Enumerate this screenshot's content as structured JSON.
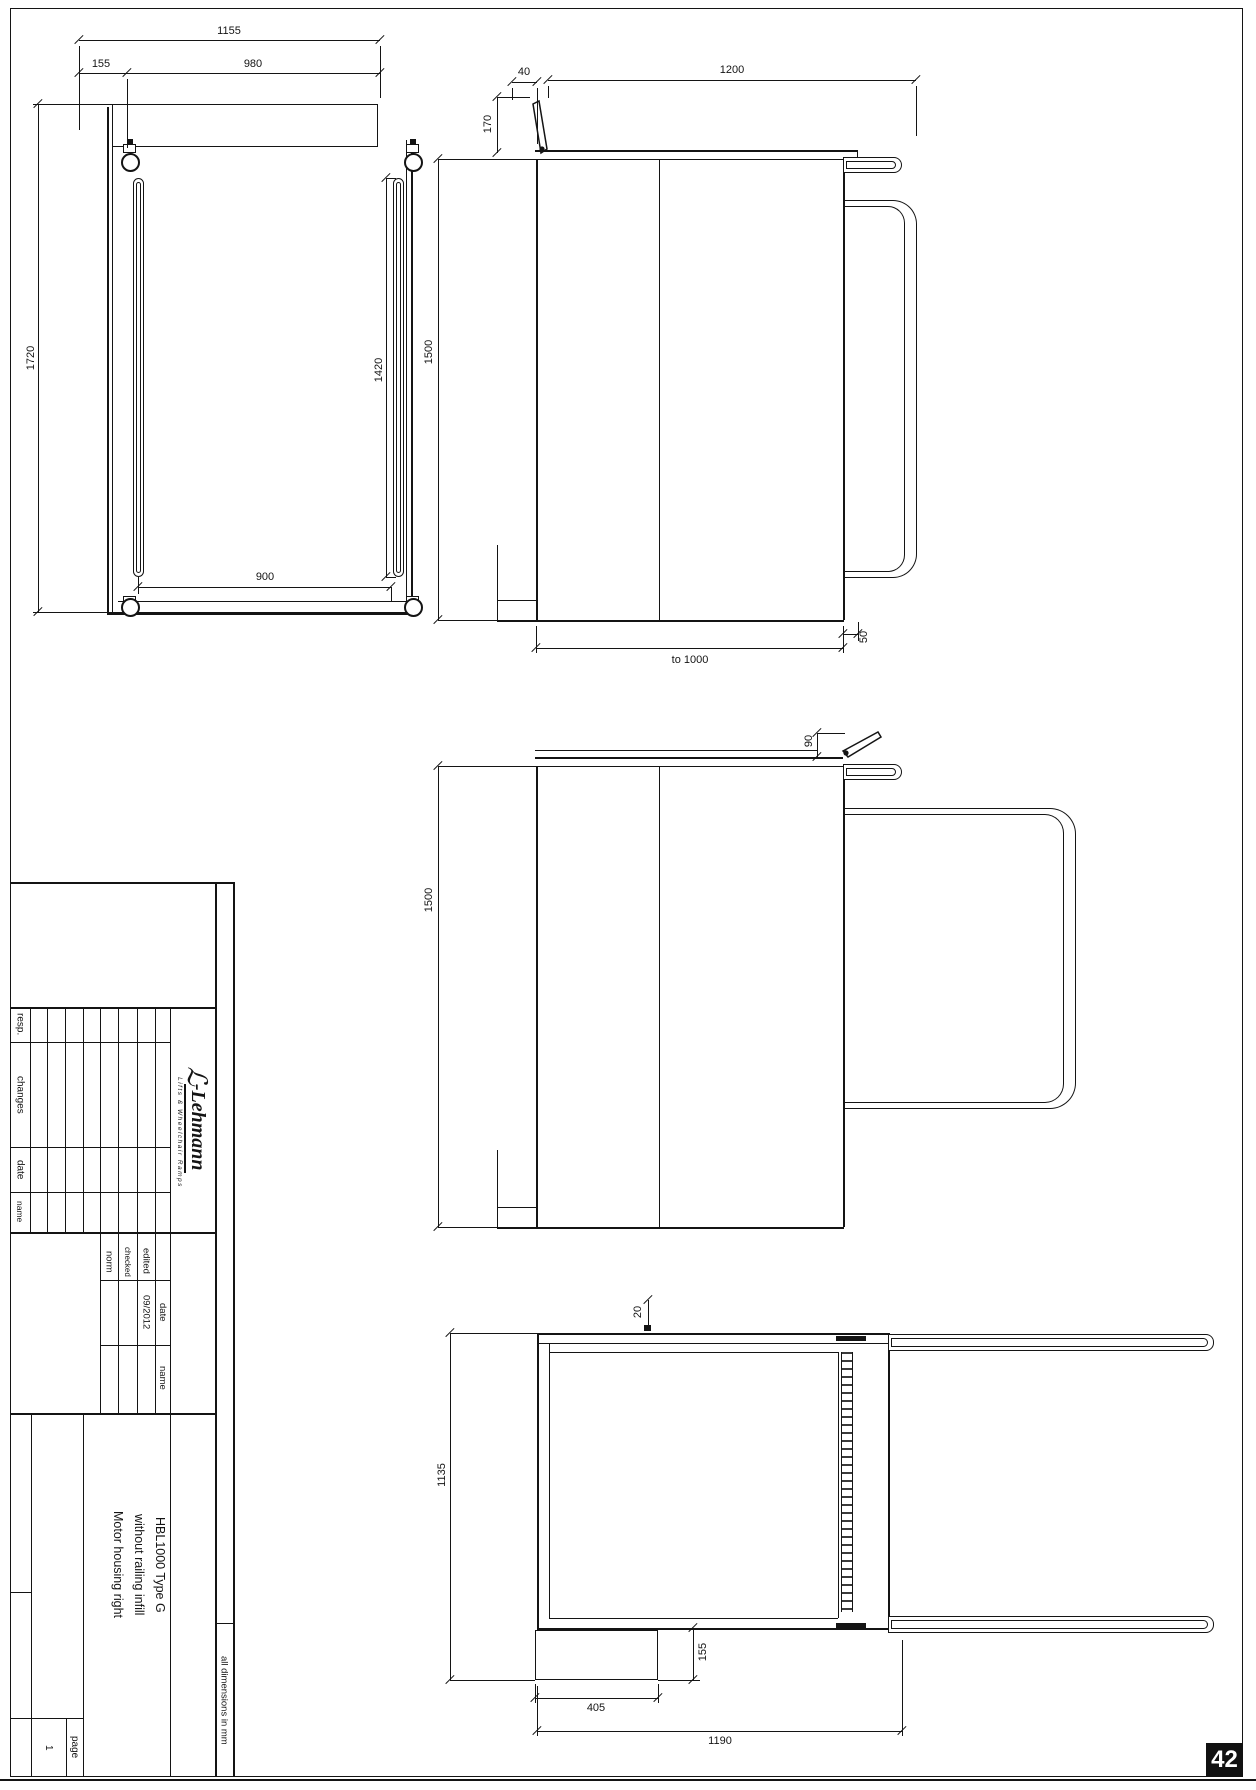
{
  "sheet": {
    "page_badge": "42"
  },
  "dims": {
    "plan": {
      "overall": "1155",
      "left": "155",
      "inner": "980",
      "length": "1720",
      "slots": "1420",
      "rollers": "900"
    },
    "side_upper": {
      "flap": "40",
      "deck": "1200",
      "flap_h": "170",
      "height": "1500",
      "travel": "to  1000",
      "offset": "50"
    },
    "side_lower": {
      "flap_h": "90",
      "height": "1500"
    },
    "plan_lower": {
      "edge": "20",
      "depth": "1135",
      "housing_d": "155",
      "housing_w": "405",
      "overall": "1190"
    }
  },
  "title_block": {
    "revision_headers": {
      "resp": "resp.",
      "changes": "changes",
      "date": "date",
      "name": "name"
    },
    "approval": {
      "edited": "edited",
      "checked": "checked",
      "norm": "norm",
      "date_header": "date",
      "name_header": "name",
      "edited_date": "09/2012"
    },
    "title_lines": {
      "line1": "HBL1000 Type G",
      "line2": "without railing infill",
      "line3": "Motor housing right"
    },
    "note": "all dimensions in mm",
    "page_label": "page",
    "page_number": "1",
    "logo": {
      "mark": "ℒ",
      "name": "-Lehmann",
      "tagline": "Lifts & Wheelchair Ramps"
    }
  }
}
